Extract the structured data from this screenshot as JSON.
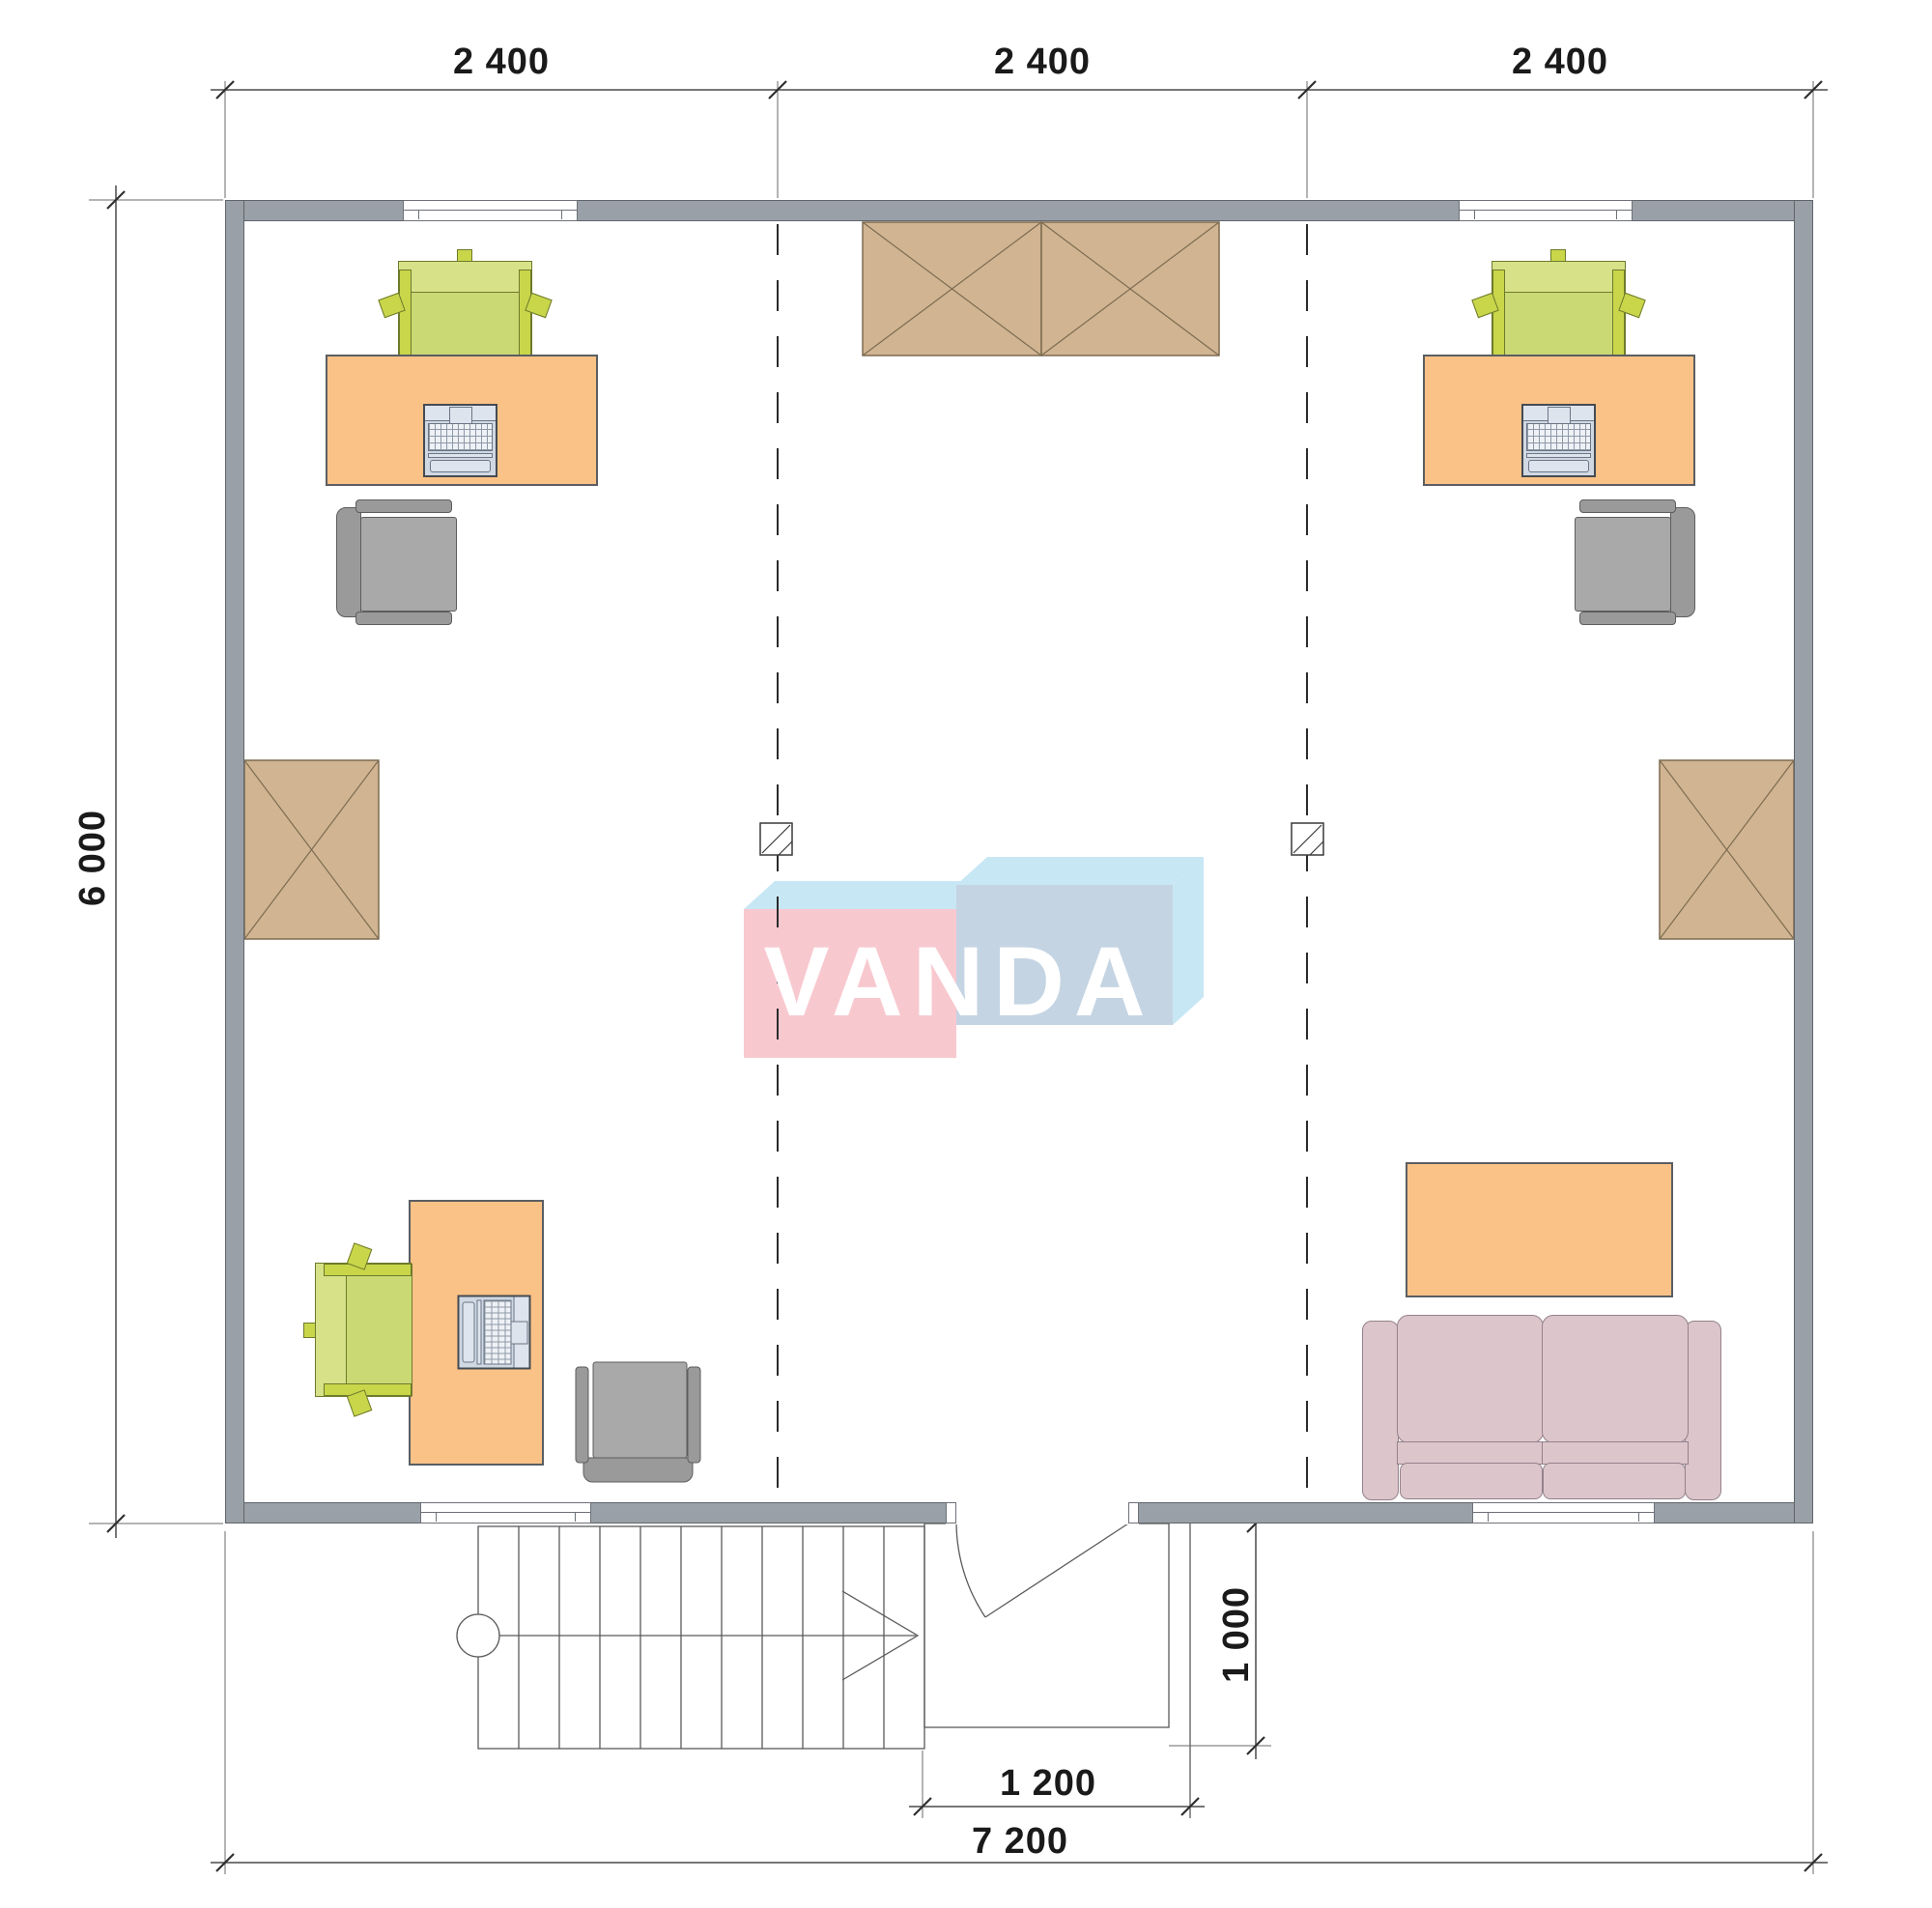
{
  "watermark": {
    "text": "VANDA"
  },
  "dimensions": {
    "top_bays": [
      "2 400",
      "2 400",
      "2 400"
    ],
    "height_total": "6 000",
    "width_total": "7 200",
    "entry_width": "1 200",
    "porch_depth": "1 000"
  },
  "colors": {
    "wall": "#9aa0a7",
    "wall_border": "#60656b",
    "desk": "#fbc287",
    "desk_border": "#5a5e63",
    "chair_green_seat": "#cbd974",
    "chair_green_back": "#d7e187",
    "chair_green_accent": "#c9d64a",
    "chair_green_border": "#6e7a2c",
    "chair_gray_seat": "#a9a9a9",
    "chair_gray_band": "#9a9a9a",
    "chair_gray_border": "#5d5d5d",
    "cabinet": "#d1b491",
    "cabinet_line": "#7d6c51",
    "sofa": "#dcc5cb",
    "sofa_border": "#94828b",
    "laptop_body": "#cfd8e3",
    "laptop_panel": "#dde4ed",
    "laptop_border": "#454b52",
    "logo_pink": "#f8c8cf",
    "logo_blue_front": "#c4d4e3",
    "logo_blue_light": "#c8e7f5",
    "text": "#1a1a1a"
  }
}
